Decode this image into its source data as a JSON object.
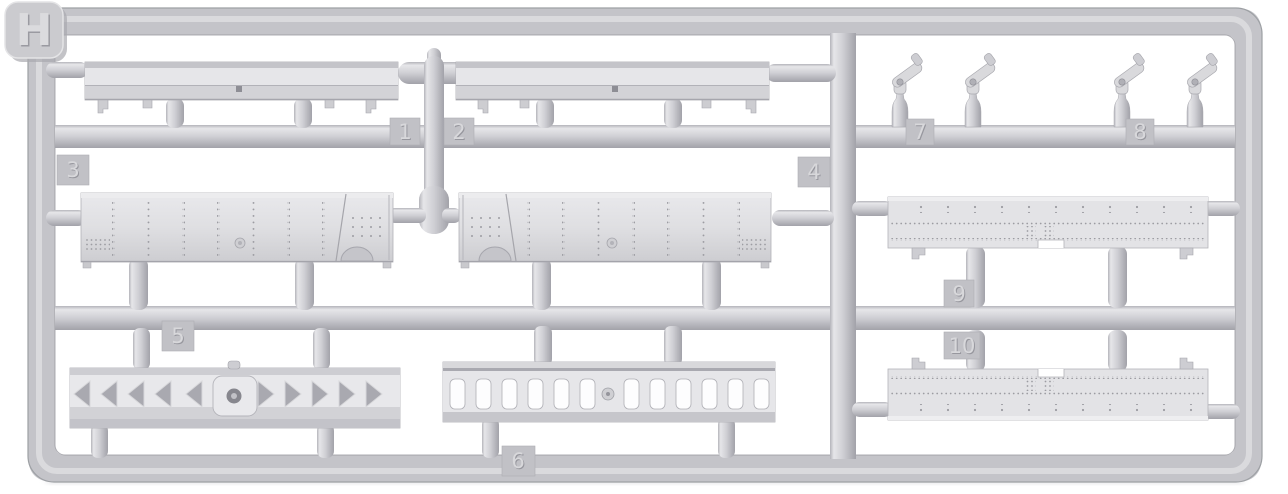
{
  "sprue": {
    "letter": "H",
    "tags": [
      "1",
      "2",
      "3",
      "4",
      "5",
      "6",
      "7",
      "8",
      "9",
      "10"
    ]
  },
  "colors": {
    "background": "#ffffff",
    "plastic": "#c9c9ce",
    "plastic_highlight": "#e6e6e9",
    "plastic_shadow": "#a4a4ab",
    "tag_plate": "#c1c1c6"
  }
}
